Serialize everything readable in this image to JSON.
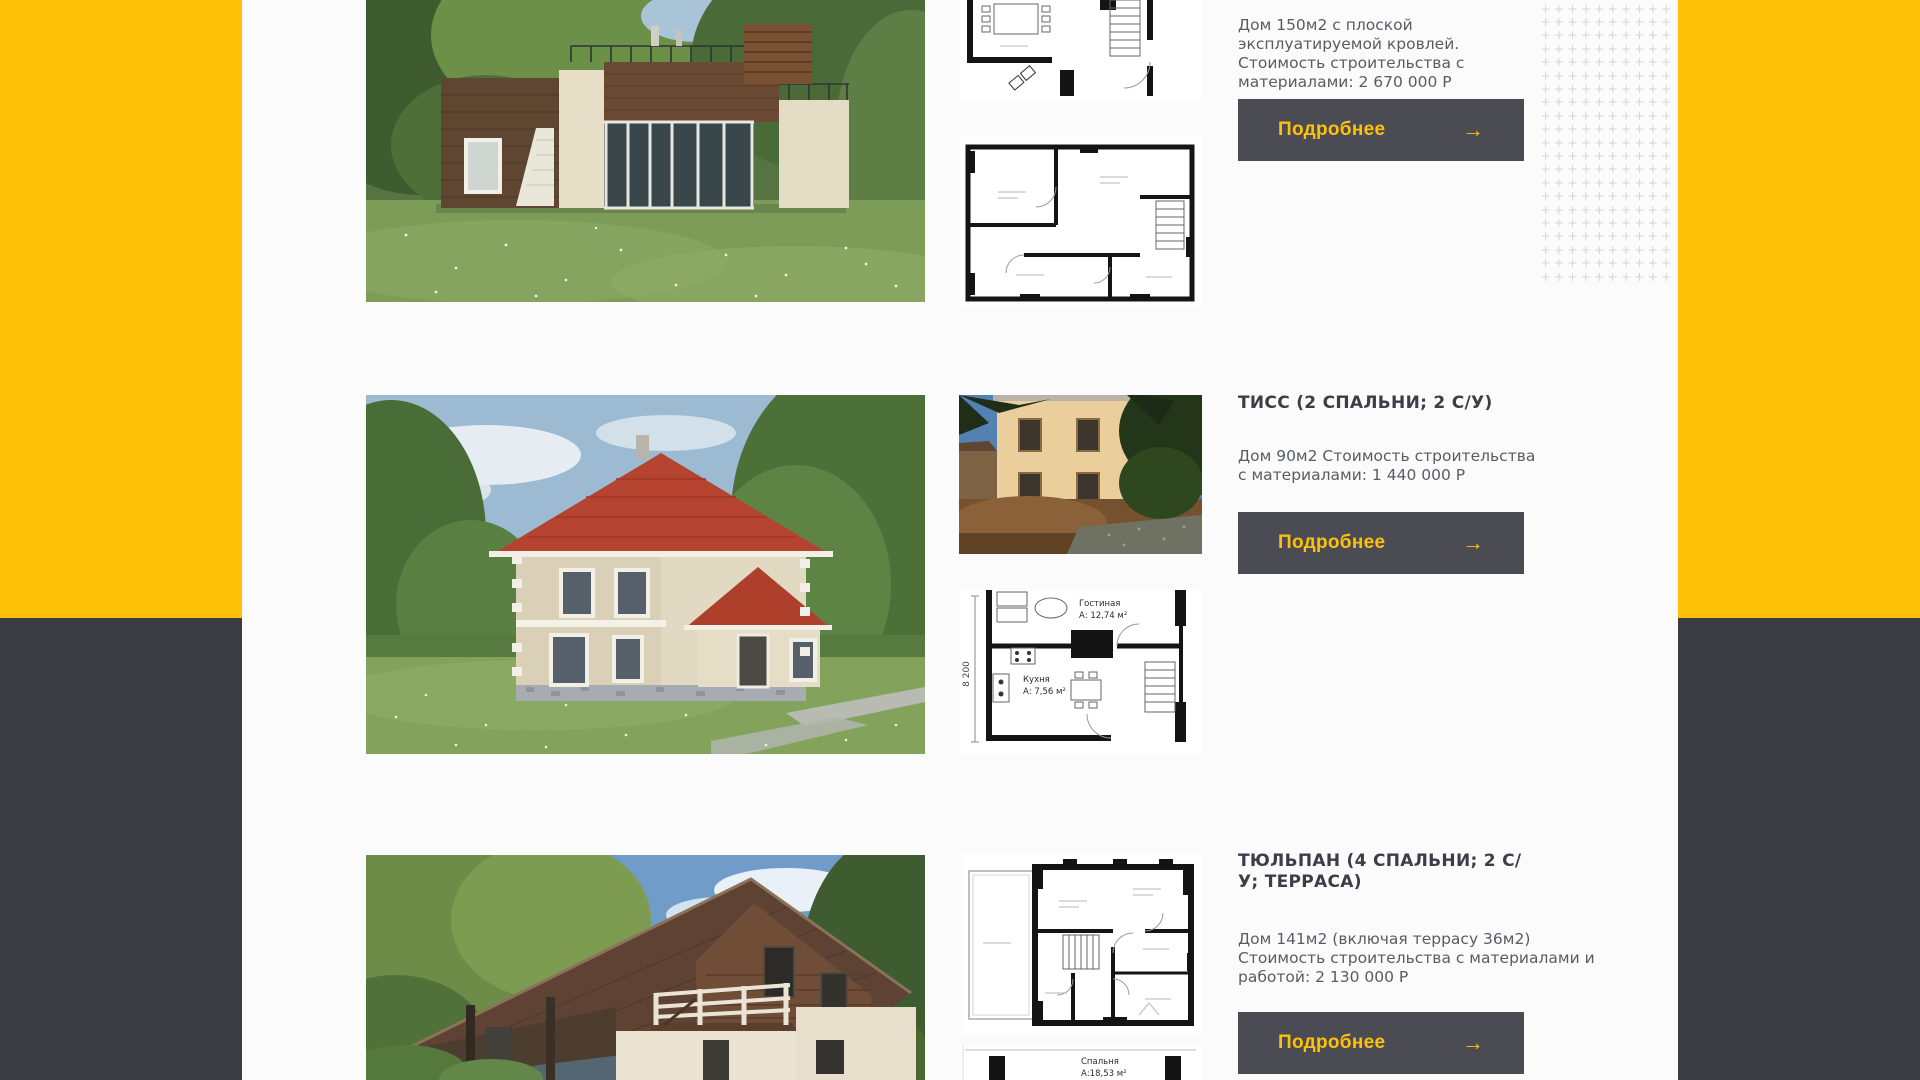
{
  "theme": {
    "accent_yellow": "#FFC107",
    "panel_dark": "#3A3B43",
    "button_background": "#4B4B54",
    "title_color": "#3C3D47",
    "text_color": "#5A5C64",
    "plus_pattern_color": "#D4D5DA"
  },
  "cards": [
    {
      "description": "Дом 150м2 с плоской эксплуатируемой кровлей. Стоимость строительства с материалами: 2 670 000 Р",
      "button_label": "Подробнее",
      "button_arrow": "→"
    },
    {
      "title": "ТИСС (2 СПАЛЬНИ; 2 С/У)",
      "description": "Дом 90м2 Стоимость строительства с материалами: 1 440 000 Р",
      "button_label": "Подробнее",
      "button_arrow": "→",
      "floorplan": {
        "dimension_label": "8 200",
        "room1_name": "Гостиная",
        "room1_area": "А: 12,74 м²",
        "room2_name": "Кухня",
        "room2_area": "А: 7,56 м²"
      }
    },
    {
      "title": "ТЮЛЬПАН (4 СПАЛЬНИ; 2 С/У; ТЕРРАСА)",
      "description": "Дом 141м2 (включая террасу 36м2) Стоимость строительства с материалами и работой: 2 130 000 Р",
      "button_label": "Подробнее",
      "button_arrow": "→",
      "floorplan_fragment": {
        "room_name": "Спальня",
        "room_area": "А:18,53 м²"
      }
    }
  ]
}
